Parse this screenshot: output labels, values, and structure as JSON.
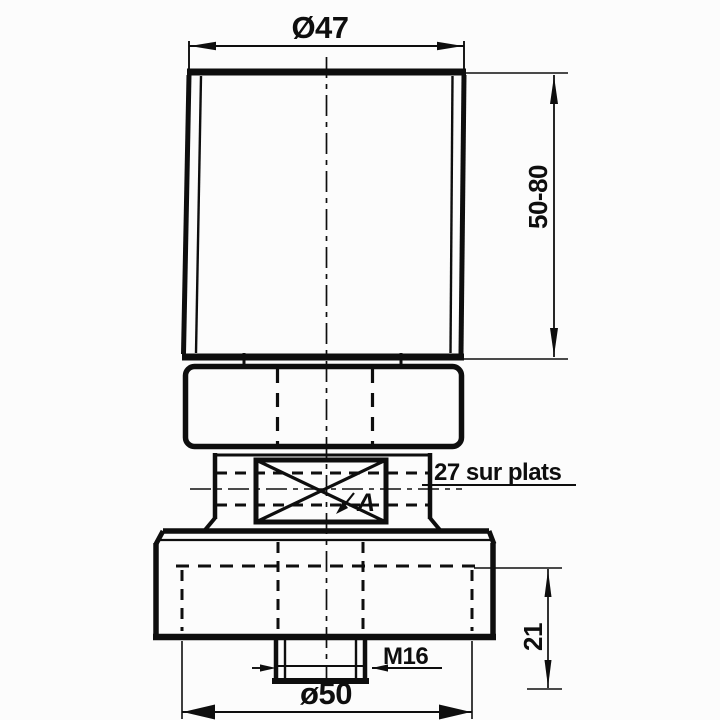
{
  "drawing": {
    "kind": "technical-drawing",
    "colors": {
      "ink": "#0e0e0e",
      "paper": "#fcfcfc"
    },
    "labels": {
      "top_diameter": "Ø47",
      "height_range": "50-80",
      "flats": "27 sur plats",
      "detail_marker": "A",
      "thread": "M16",
      "bore_diameter": "ø50",
      "cavity_height": "21"
    }
  }
}
